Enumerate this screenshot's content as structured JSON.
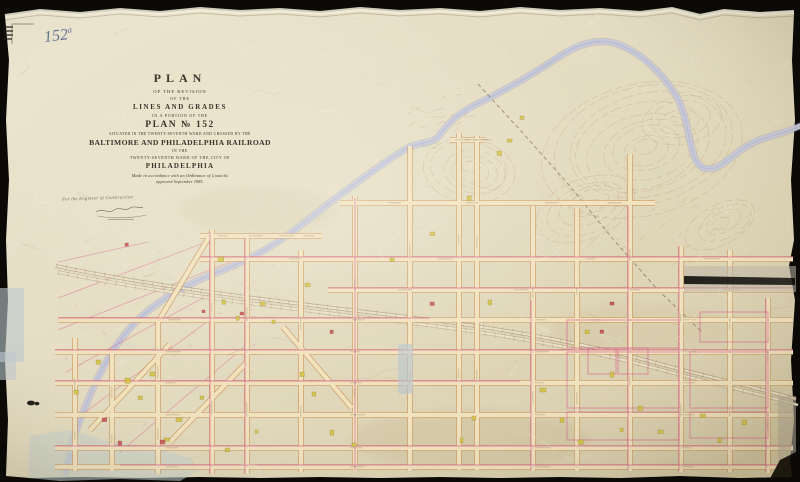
{
  "page": {
    "background": "#0b0a07",
    "width": 800,
    "height": 482
  },
  "corner_annotation": {
    "number": "152",
    "superscript": "a",
    "ink": "#4f5f86"
  },
  "title_block": {
    "ink": "#3b352b",
    "lines": [
      {
        "text": "PLAN",
        "size": 12,
        "weight": "bold",
        "ls": 5,
        "mt": 0
      },
      {
        "text": "OF THE REVISION",
        "size": 4.6,
        "weight": "normal",
        "ls": 1,
        "mt": 3
      },
      {
        "text": "OF THE",
        "size": 4,
        "weight": "normal",
        "ls": 1,
        "mt": 2
      },
      {
        "text": "LINES AND GRADES",
        "size": 7,
        "weight": "bold",
        "ls": 1.6,
        "mt": 2
      },
      {
        "text": "IN A PORTION OF THE",
        "size": 4,
        "weight": "normal",
        "ls": 0.8,
        "mt": 2
      },
      {
        "text": "PLAN № 152",
        "size": 9.5,
        "weight": "bold",
        "ls": 1.5,
        "mt": 2
      },
      {
        "text": "SITUATED IN THE TWENTY-SEVENTH WARD AND CROSSED BY THE",
        "size": 3.8,
        "weight": "normal",
        "ls": 0.4,
        "mt": 2
      },
      {
        "text": "BALTIMORE AND PHILADELPHIA RAILROAD",
        "size": 7.6,
        "weight": "bold",
        "ls": 0.4,
        "mt": 2
      },
      {
        "text": "IN THE",
        "size": 3.8,
        "weight": "normal",
        "ls": 0.6,
        "mt": 2
      },
      {
        "text": "TWENTY-SEVENTH WARD OF THE CITY OF",
        "size": 4,
        "weight": "normal",
        "ls": 0.6,
        "mt": 2
      },
      {
        "text": "PHILADELPHIA",
        "size": 7,
        "weight": "bold",
        "ls": 1.2,
        "mt": 2
      },
      {
        "text": "Made in accordance with an Ordinance of Councils",
        "size": 4.2,
        "weight": "normal",
        "style": "italic",
        "ls": 0.2,
        "mt": 3
      },
      {
        "text": "approved September 1885.",
        "size": 4,
        "weight": "normal",
        "style": "italic",
        "ls": 0.2,
        "mt": 1
      }
    ]
  },
  "engineer_note": {
    "text": "For the Engineer of Construction",
    "ink": "#6b5a42"
  },
  "paper": {
    "color_light": "#ece6d1",
    "color_mid": "#e4dcc1",
    "color_dark": "#d6cba7",
    "outline": [
      [
        5,
        16
      ],
      [
        40,
        11
      ],
      [
        80,
        14
      ],
      [
        120,
        10
      ],
      [
        160,
        13
      ],
      [
        200,
        9
      ],
      [
        240,
        12
      ],
      [
        280,
        10
      ],
      [
        320,
        13
      ],
      [
        360,
        9
      ],
      [
        400,
        12
      ],
      [
        440,
        10
      ],
      [
        480,
        13
      ],
      [
        520,
        9
      ],
      [
        560,
        12
      ],
      [
        600,
        10
      ],
      [
        640,
        13
      ],
      [
        672,
        9
      ],
      [
        700,
        16
      ],
      [
        724,
        11
      ],
      [
        760,
        14
      ],
      [
        794,
        12
      ],
      [
        792,
        60
      ],
      [
        795,
        120
      ],
      [
        791,
        180
      ],
      [
        794,
        240
      ],
      [
        789,
        266
      ],
      [
        795,
        300
      ],
      [
        791,
        360
      ],
      [
        794,
        420
      ],
      [
        790,
        460
      ],
      [
        792,
        477
      ],
      [
        740,
        478
      ],
      [
        680,
        476
      ],
      [
        620,
        478
      ],
      [
        560,
        477
      ],
      [
        500,
        478
      ],
      [
        440,
        477
      ],
      [
        380,
        478
      ],
      [
        320,
        477
      ],
      [
        260,
        478
      ],
      [
        200,
        477
      ],
      [
        140,
        478
      ],
      [
        80,
        477
      ],
      [
        30,
        478
      ],
      [
        6,
        476
      ],
      [
        8,
        420
      ],
      [
        5,
        360
      ],
      [
        8,
        300
      ],
      [
        6,
        240
      ],
      [
        9,
        180
      ],
      [
        6,
        120
      ],
      [
        9,
        60
      ]
    ]
  },
  "map": {
    "colors": {
      "street_edge": "#c68a4f",
      "street_fill": "#f1e2bd",
      "pink": "#d4558b",
      "creek_fill": "#c6c9dc",
      "creek_edge": "#918eae",
      "wash": "#c3d0cc",
      "contour": "#b88c68",
      "railroad": "#8a745a",
      "building_yellow": "#d3c23e",
      "building_red": "#c8454a",
      "smudge": "#7a6a50",
      "ink_black": "#14120d"
    },
    "streets": {
      "vertical": [
        [
          75,
          338,
          471
        ],
        [
          112,
          350,
          471
        ],
        [
          158,
          320,
          474
        ],
        [
          212,
          230,
          474
        ],
        [
          247,
          236,
          474
        ],
        [
          301,
          250,
          472
        ],
        [
          355,
          196,
          471
        ],
        [
          410,
          146,
          471
        ],
        [
          459,
          133,
          470
        ],
        [
          477,
          136,
          470
        ],
        [
          533,
          206,
          471
        ],
        [
          577,
          208,
          471
        ],
        [
          630,
          154,
          471
        ],
        [
          681,
          246,
          472
        ],
        [
          730,
          250,
          472
        ],
        [
          768,
          298,
          473
        ]
      ],
      "horizontal": [
        [
          203,
          340,
          655
        ],
        [
          236,
          200,
          322
        ],
        [
          259,
          200,
          793
        ],
        [
          290,
          328,
          793
        ],
        [
          320,
          58,
          793
        ],
        [
          352,
          55,
          793
        ],
        [
          383,
          55,
          793
        ],
        [
          415,
          55,
          793
        ],
        [
          448,
          55,
          793
        ],
        [
          467,
          55,
          793
        ],
        [
          140,
          450,
          486
        ]
      ],
      "diagonal": [
        [
          90,
          430,
          170,
          344
        ],
        [
          170,
          442,
          247,
          362
        ],
        [
          283,
          327,
          352,
          408
        ],
        [
          158,
          322,
          212,
          232
        ]
      ]
    },
    "pink_segments": [
      [
        58,
        318,
        430,
        318
      ],
      [
        55,
        350,
        793,
        350
      ],
      [
        55,
        381,
        520,
        381
      ],
      [
        55,
        446,
        793,
        446
      ],
      [
        120,
        465,
        793,
        465
      ],
      [
        200,
        257,
        793,
        257
      ],
      [
        328,
        288,
        793,
        288
      ],
      [
        531,
        300,
        531,
        470
      ],
      [
        628,
        206,
        628,
        470
      ],
      [
        679,
        246,
        679,
        471
      ],
      [
        766,
        298,
        766,
        472
      ],
      [
        210,
        232,
        210,
        474
      ],
      [
        245,
        238,
        245,
        474
      ],
      [
        355,
        198,
        355,
        470
      ]
    ],
    "pink_rects": [
      [
        567,
        320,
        112,
        28
      ],
      [
        567,
        352,
        112,
        56
      ],
      [
        690,
        352,
        78,
        56
      ],
      [
        567,
        412,
        112,
        28
      ],
      [
        690,
        412,
        78,
        26
      ],
      [
        588,
        348,
        28,
        26
      ],
      [
        618,
        348,
        30,
        26
      ],
      [
        700,
        312,
        68,
        30
      ]
    ],
    "pink_diagonals": [
      [
        58,
        298,
        212,
        240
      ],
      [
        58,
        330,
        230,
        262
      ],
      [
        66,
        372,
        214,
        292
      ],
      [
        80,
        416,
        212,
        318
      ],
      [
        120,
        452,
        250,
        342
      ],
      [
        58,
        262,
        148,
        242
      ]
    ],
    "railroad": {
      "path": "M 56,266 C 160,288 300,304 400,316 C 500,328 580,342 660,364 C 720,380 762,389 796,399",
      "second_offset": [
        2,
        6
      ]
    },
    "survey_dashes": "M 478,84 L 521,131 L 569,185 L 613,239 L 657,289 L 701,331",
    "creek": {
      "path": "M 800,126 C 778,136 762,136 744,148 C 726,160 718,172 704,168 C 688,163 691,122 677,97 C 663,74 641,52 617,44 C 595,37 575,46 557,58 C 533,74 509,88 485,100 C 467,108 452,118 442,132 C 434,146 420,140 404,150 C 378,166 330,202 300,226 C 272,248 244,262 218,272 C 192,282 164,296 142,316 C 120,336 106,360 95,384 C 86,404 78,424 72,444 L 66,472",
      "wash": "30,436 70,430 110,442 150,446 190,458 200,470 180,481 120,479 60,481 28,478"
    },
    "contours": [
      {
        "cx": 645,
        "cy": 148,
        "n": 9,
        "rx": 102,
        "ry": 66,
        "rot": -14
      },
      {
        "cx": 588,
        "cy": 206,
        "n": 5,
        "rx": 52,
        "ry": 30,
        "rot": -22
      },
      {
        "cx": 472,
        "cy": 170,
        "n": 6,
        "rx": 46,
        "ry": 32,
        "rot": 8
      },
      {
        "cx": 722,
        "cy": 224,
        "n": 4,
        "rx": 38,
        "ry": 20,
        "rot": -28
      },
      {
        "cx": 680,
        "cy": 120,
        "n": 4,
        "rx": 40,
        "ry": 24,
        "rot": -10
      }
    ],
    "buildings": {
      "yellow": [
        [
          520,
          116
        ],
        [
          507,
          139
        ],
        [
          497,
          151
        ],
        [
          467,
          196
        ],
        [
          305,
          283
        ],
        [
          218,
          257
        ],
        [
          150,
          372
        ],
        [
          138,
          396
        ],
        [
          176,
          418
        ],
        [
          164,
          438
        ],
        [
          222,
          300
        ],
        [
          236,
          316
        ],
        [
          260,
          302
        ],
        [
          272,
          320
        ],
        [
          300,
          372
        ],
        [
          312,
          392
        ],
        [
          330,
          430
        ],
        [
          352,
          443
        ],
        [
          460,
          438
        ],
        [
          472,
          416
        ],
        [
          488,
          300
        ],
        [
          540,
          388
        ],
        [
          560,
          418
        ],
        [
          578,
          440
        ],
        [
          620,
          428
        ],
        [
          638,
          406
        ],
        [
          658,
          430
        ],
        [
          700,
          414
        ],
        [
          718,
          438
        ],
        [
          742,
          420
        ],
        [
          390,
          258
        ],
        [
          430,
          232
        ],
        [
          585,
          330
        ],
        [
          610,
          372
        ],
        [
          74,
          390
        ],
        [
          96,
          360
        ],
        [
          125,
          378
        ],
        [
          200,
          396
        ],
        [
          255,
          430
        ],
        [
          225,
          448
        ]
      ],
      "red": [
        [
          125,
          243
        ],
        [
          202,
          310
        ],
        [
          160,
          440
        ],
        [
          240,
          312
        ],
        [
          330,
          330
        ],
        [
          430,
          302
        ],
        [
          610,
          302
        ],
        [
          102,
          418
        ],
        [
          118,
          441
        ],
        [
          600,
          330
        ]
      ]
    },
    "hatch_regions": [
      {
        "x": 560,
        "y": 200,
        "w": 200,
        "h": 70,
        "n": 40,
        "color": "#b08a66",
        "op": 0.3,
        "angle": -35
      },
      {
        "x": 405,
        "y": 95,
        "w": 52,
        "h": 42,
        "n": 14,
        "color": "#c06a55",
        "op": 0.3,
        "angle": -20
      },
      {
        "x": 150,
        "y": 255,
        "w": 150,
        "h": 78,
        "n": 26,
        "color": "#c06080",
        "op": 0.22,
        "angle": 15
      }
    ],
    "stains": [
      [
        470,
        440,
        120,
        30,
        "#c7b88f",
        0.35
      ],
      [
        260,
        210,
        80,
        24,
        "#d9cfae",
        0.4
      ],
      [
        640,
        330,
        90,
        26,
        "#cfc09a",
        0.3
      ]
    ],
    "damage": {
      "left_patches": [
        [
          0,
          288,
          24,
          74
        ],
        [
          0,
          352,
          16,
          28
        ]
      ],
      "blue_streak": [
        398,
        344,
        15,
        50
      ],
      "right_tear_patch": [
        684,
        266,
        112,
        26
      ],
      "right_tear_gash": "684,276 795,278 795,285 684,284",
      "right_gray_strip": [
        778,
        396,
        18,
        84
      ],
      "corner_black": "780,460 800,450 800,482 768,482",
      "ink_blot": [
        31,
        403
      ]
    },
    "border": {
      "corner_path": "M 12,44 L 12,24 L 34,24",
      "comb_ticks": [
        [
          3,
          27,
          13,
          27
        ],
        [
          3,
          31,
          13,
          31
        ],
        [
          3,
          35,
          13,
          35
        ],
        [
          3,
          39,
          12,
          39
        ]
      ]
    },
    "signature": {
      "squiggle": "M 96,212 c 8,-5 12,3 18,-2 c 6,-4 10,2 16,-2 c 5,-3 9,1 13,-1",
      "underline": "M 98,216 c 14,3 36,2 48,-1"
    }
  }
}
